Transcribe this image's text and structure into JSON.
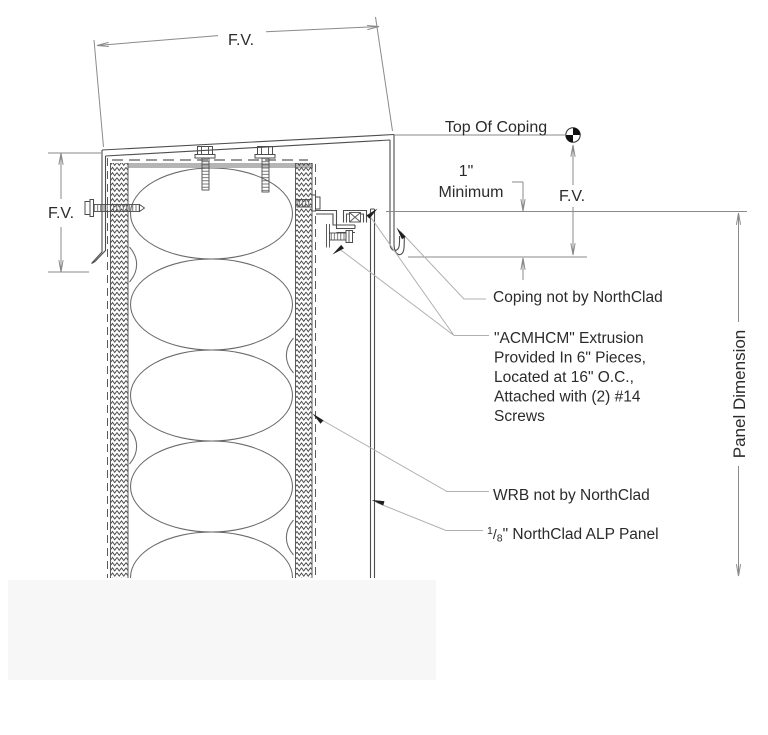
{
  "drawing": {
    "title_labels": {
      "top_of_coping": "Top Of Coping",
      "panel_dimension": "Panel Dimension"
    },
    "dimensions": {
      "top_width": "F.V.",
      "left_height": "F.V.",
      "coping_face": "F.V.",
      "overlap_value": "1\"",
      "overlap_qualifier": "Minimum"
    },
    "annotations": {
      "coping_note": "Coping not by NorthClad",
      "extrusion_note_lines": [
        "\"ACMHCM\" Extrusion",
        "Provided In 6\" Pieces,",
        "Located at 16\" O.C.,",
        "Attached with (2) #14",
        "Screws"
      ],
      "wrb_note": "WRB not by NorthClad",
      "panel_note": {
        "numerator": "1",
        "slash": "/",
        "denominator": "8",
        "rest": "\" NorthClad ALP Panel"
      }
    },
    "colors": {
      "object_line": "#4d4d4d",
      "dimension_line": "#8a8a8a",
      "leader_line": "#b0b0b0",
      "text": "#2b2b2b",
      "plate_gray": "#b5b5b5",
      "watermark": "#f7f7f7",
      "arrow_black": "#1f1f1f"
    }
  }
}
